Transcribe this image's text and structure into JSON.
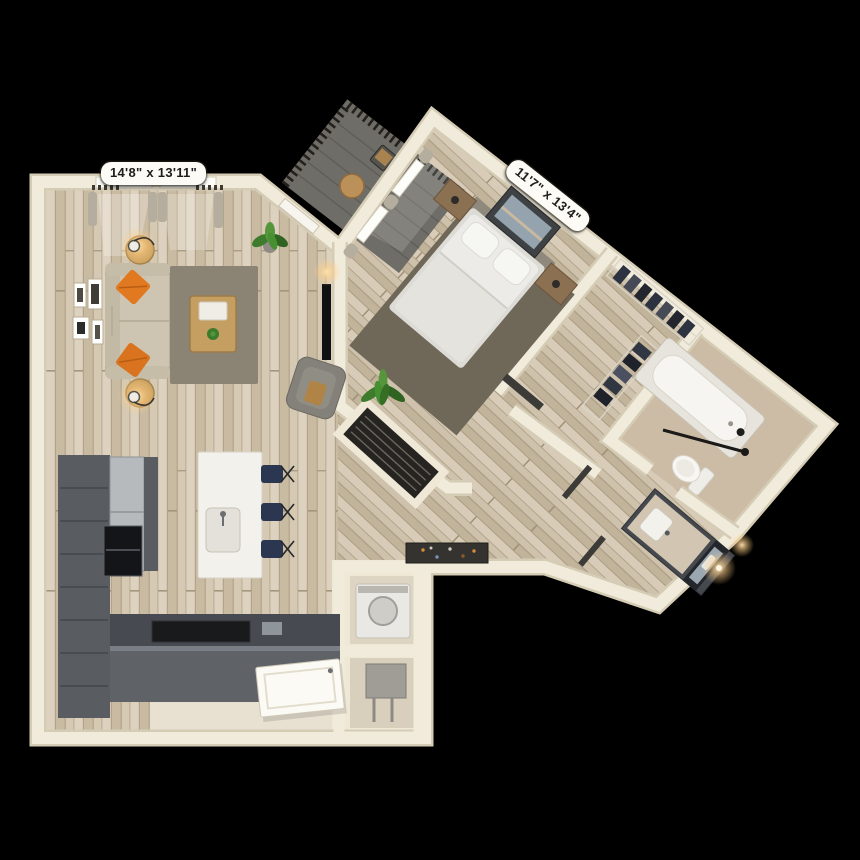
{
  "scene": {
    "type": "3d-floor-plan-render",
    "background_color": "#000000",
    "description": "Top-down 3D render of a one-bedroom, one-bathroom apartment with balcony"
  },
  "labels": {
    "living_room": {
      "text": "14'8\" x 13'11\"",
      "rotation_deg": 0
    },
    "bedroom": {
      "text": "11'7\" x 13'4\"",
      "rotation_deg": 38.5
    }
  },
  "rooms": [
    {
      "name": "Living Room",
      "dimensions": "14'8\" x 13'11\"",
      "furniture": [
        "beige sofa with two orange pillows",
        "gray area rug",
        "wood coffee table",
        "two round side tables with lamps",
        "gallery wall of four frames",
        "TV",
        "gray armchair",
        "potted plant",
        "two curtained windows"
      ]
    },
    {
      "name": "Kitchen",
      "furniture": [
        "dark gray L-shaped cabinets",
        "stainless refrigerator",
        "black wall oven",
        "white island with sink and faucet",
        "three navy bar stools",
        "dark peninsula counter"
      ]
    },
    {
      "name": "Bedroom",
      "dimensions": "11'7\" x 13'4\"",
      "furniture": [
        "white queen bed with headboard",
        "two wood nightstands",
        "framed art above bed",
        "dark gray area rug",
        "potted plant",
        "curtained windows to balcony"
      ]
    },
    {
      "name": "Walk-in Closet",
      "furniture": [
        "wire shelving",
        "hanging dark clothes"
      ]
    },
    {
      "name": "Bathroom",
      "furniture": [
        "bathtub with black fixtures",
        "toilet",
        "dark vanity with sink",
        "leaning mirror",
        "lit sconces"
      ]
    },
    {
      "name": "Balcony",
      "furniture": [
        "dark railing",
        "round bistro table",
        "chair"
      ]
    },
    {
      "name": "Entry",
      "furniture": [
        "open white entry door",
        "doormat",
        "washer niche",
        "utility niche"
      ]
    }
  ],
  "colors": {
    "wall": "#f1ebdb",
    "wall_shadow": "#d5ccb5",
    "wood_floor": "#d3c6b0",
    "bath_floor": "#ccbca5",
    "entry_tile": "#e8e1d1",
    "living_rug": "#8b8374",
    "bedroom_rug": "#6f6859",
    "cabinet": "#595d62",
    "island": "#f2f1ec",
    "sofa": "#cdc4b1",
    "pillow_orange": "#e0791f",
    "stool_navy": "#2b3750",
    "bed_white": "#ecebe7",
    "balcony_floor": "#6f6d67",
    "railing": "#22211e",
    "plant_green": "#3e7b2d",
    "label_bg": "#fcfbf5",
    "label_text": "#1d1d1b"
  }
}
